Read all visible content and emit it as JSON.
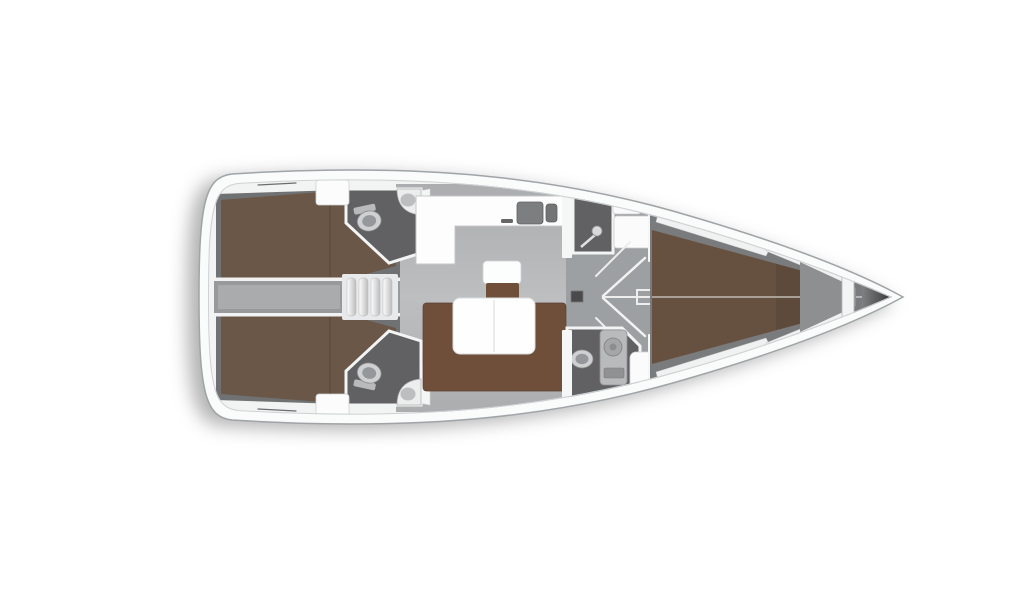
{
  "diagram": {
    "type": "yacht-interior-floor-plan",
    "orientation": "bow-right-stern-left",
    "regions": [
      "aft-cabin-port",
      "aft-cabin-starboard",
      "engine-compartment",
      "companionway-stairs",
      "aft-head-port",
      "aft-head-starboard",
      "galley",
      "salon",
      "salon-table",
      "salon-sofa",
      "salon-stool",
      "shower-room",
      "forward-head",
      "corridor",
      "forward-cabin-vberth",
      "anchor-locker",
      "bow-cone"
    ],
    "fixtures": [
      "toilet-icon",
      "corner-sink-icon",
      "double-sink-icon",
      "shower-head-icon",
      "shower-column-icon",
      "door-swing-icon",
      "stair-treads-icon"
    ]
  },
  "palette": {
    "bg": "#ffffff",
    "hull_fill": "#fafbfb",
    "hull_outline": "#9fa4a7",
    "inner_line": "#cfd3d5",
    "wall_white": "#f2f3f3",
    "salon_floor": "#b6b7b9",
    "corridor_floor": "#9da0a2",
    "cabin_floor": "#707173",
    "head_floor": "#616163",
    "engine_gray": "#97999b",
    "engine_inner": "#a9abad",
    "bed_brown": "#6b5747",
    "fwd_bed_brown": "#66503f",
    "sofa_brown": "#6f4f39",
    "counter_white": "#fdfdfd",
    "sink_dark": "#7d7e80",
    "fixture_light": "#cfd0d1",
    "fixture_mid": "#96979a",
    "shelf_white": "#f0f1f1",
    "locker_gray": "#8e8f91",
    "bow_dark": "#161616"
  }
}
